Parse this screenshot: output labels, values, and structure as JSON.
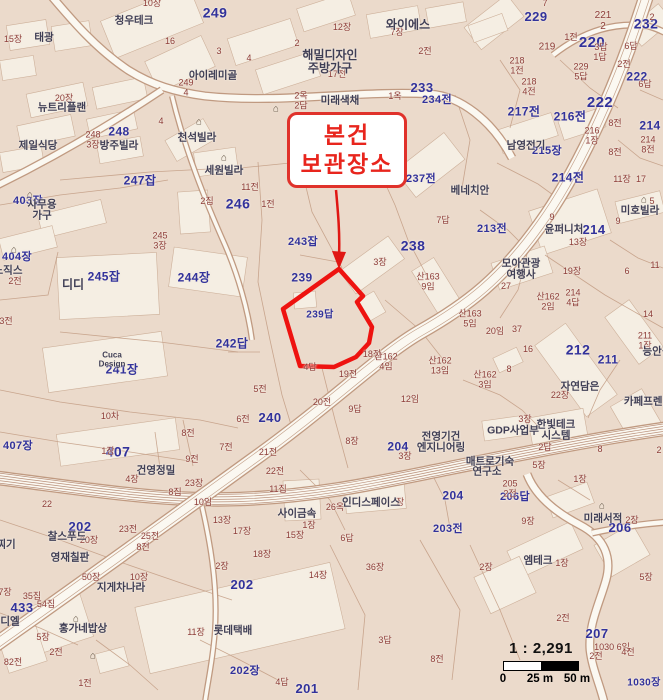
{
  "callout": {
    "text": "본건\n보관장소"
  },
  "scalebar": {
    "ratio": "1 : 2,291",
    "tick_0": "0",
    "tick_25": "25 m",
    "tick_50": "50 m"
  },
  "colors": {
    "map_background": "#ebdacb",
    "lot_number_blue": "#32329b",
    "sub_lot_red": "#8d3c38",
    "building_name": "#3f3e55",
    "highlight_red": "#ee1310"
  },
  "map_labels": [
    {
      "t": "249",
      "x": 215,
      "y": 13,
      "c": "b",
      "s": 14
    },
    {
      "t": "229",
      "x": 536,
      "y": 17,
      "c": "b",
      "s": 13
    },
    {
      "t": "220",
      "x": 592,
      "y": 43,
      "c": "b",
      "s": 15
    },
    {
      "t": "232",
      "x": 646,
      "y": 24,
      "c": "b",
      "s": 14
    },
    {
      "t": "233",
      "x": 422,
      "y": 88,
      "c": "b",
      "s": 13
    },
    {
      "t": "234전",
      "x": 437,
      "y": 101,
      "c": "b",
      "s": 11
    },
    {
      "t": "238",
      "x": 413,
      "y": 246,
      "c": "b",
      "s": 14
    },
    {
      "t": "237전",
      "x": 421,
      "y": 180,
      "c": "b",
      "s": 11
    },
    {
      "t": "213전",
      "x": 492,
      "y": 230,
      "c": "b",
      "s": 11
    },
    {
      "t": "214",
      "x": 594,
      "y": 230,
      "c": "b",
      "s": 13
    },
    {
      "t": "214전",
      "x": 568,
      "y": 178,
      "c": "b",
      "s": 12
    },
    {
      "t": "217전",
      "x": 524,
      "y": 112,
      "c": "b",
      "s": 12
    },
    {
      "t": "216전",
      "x": 570,
      "y": 117,
      "c": "b",
      "s": 12
    },
    {
      "t": "214",
      "x": 650,
      "y": 126,
      "c": "b",
      "s": 12
    },
    {
      "t": "222",
      "x": 600,
      "y": 103,
      "c": "b",
      "s": 15
    },
    {
      "t": "222",
      "x": 637,
      "y": 77,
      "c": "b",
      "s": 12
    },
    {
      "t": "212",
      "x": 578,
      "y": 350,
      "c": "b",
      "s": 14
    },
    {
      "t": "211",
      "x": 608,
      "y": 360,
      "c": "b",
      "s": 12
    },
    {
      "t": "239",
      "x": 302,
      "y": 278,
      "c": "b",
      "s": 12
    },
    {
      "t": "239답",
      "x": 320,
      "y": 316,
      "c": "b",
      "s": 10
    },
    {
      "t": "243잡",
      "x": 303,
      "y": 243,
      "c": "b",
      "s": 11
    },
    {
      "t": "247잡",
      "x": 140,
      "y": 181,
      "c": "b",
      "s": 12
    },
    {
      "t": "246",
      "x": 238,
      "y": 204,
      "c": "b",
      "s": 14
    },
    {
      "t": "248",
      "x": 119,
      "y": 132,
      "c": "b",
      "s": 12
    },
    {
      "t": "245잡",
      "x": 104,
      "y": 277,
      "c": "b",
      "s": 12
    },
    {
      "t": "244장",
      "x": 194,
      "y": 278,
      "c": "b",
      "s": 12
    },
    {
      "t": "242답",
      "x": 232,
      "y": 344,
      "c": "b",
      "s": 12
    },
    {
      "t": "241장",
      "x": 122,
      "y": 370,
      "c": "b",
      "s": 12
    },
    {
      "t": "240",
      "x": 270,
      "y": 418,
      "c": "b",
      "s": 13
    },
    {
      "t": "407",
      "x": 118,
      "y": 452,
      "c": "b",
      "s": 14
    },
    {
      "t": "407장",
      "x": 18,
      "y": 447,
      "c": "b",
      "s": 11
    },
    {
      "t": "433",
      "x": 22,
      "y": 608,
      "c": "b",
      "s": 13
    },
    {
      "t": "404장",
      "x": 17,
      "y": 258,
      "c": "b",
      "s": 11
    },
    {
      "t": "403장",
      "x": 28,
      "y": 202,
      "c": "b",
      "s": 11
    },
    {
      "t": "202",
      "x": 80,
      "y": 527,
      "c": "b",
      "s": 13
    },
    {
      "t": "202",
      "x": 242,
      "y": 585,
      "c": "b",
      "s": 13
    },
    {
      "t": "202장",
      "x": 245,
      "y": 672,
      "c": "b",
      "s": 11
    },
    {
      "t": "201",
      "x": 307,
      "y": 689,
      "c": "b",
      "s": 13
    },
    {
      "t": "204",
      "x": 453,
      "y": 496,
      "c": "b",
      "s": 12
    },
    {
      "t": "203전",
      "x": 448,
      "y": 530,
      "c": "b",
      "s": 11
    },
    {
      "t": "204",
      "x": 398,
      "y": 447,
      "c": "b",
      "s": 12
    },
    {
      "t": "206답",
      "x": 515,
      "y": 498,
      "c": "b",
      "s": 11
    },
    {
      "t": "206",
      "x": 620,
      "y": 528,
      "c": "b",
      "s": 13
    },
    {
      "t": "207",
      "x": 597,
      "y": 634,
      "c": "b",
      "s": 13
    },
    {
      "t": "1030장",
      "x": 644,
      "y": 684,
      "c": "b",
      "s": 10
    },
    {
      "t": "215장",
      "x": 547,
      "y": 152,
      "c": "b",
      "s": 11
    },
    {
      "t": "15장",
      "x": 13,
      "y": 40,
      "c": "r"
    },
    {
      "t": "10장",
      "x": 152,
      "y": 4,
      "c": "r"
    },
    {
      "t": "16",
      "x": 170,
      "y": 42,
      "c": "r"
    },
    {
      "t": "3",
      "x": 219,
      "y": 52,
      "c": "r"
    },
    {
      "t": "4",
      "x": 249,
      "y": 59,
      "c": "r"
    },
    {
      "t": "2",
      "x": 297,
      "y": 44,
      "c": "r"
    },
    {
      "t": "12장",
      "x": 342,
      "y": 28,
      "c": "r"
    },
    {
      "t": "7장",
      "x": 397,
      "y": 33,
      "c": "r"
    },
    {
      "t": "2전",
      "x": 425,
      "y": 52,
      "c": "r"
    },
    {
      "t": "17전",
      "x": 337,
      "y": 75,
      "c": "r"
    },
    {
      "t": "1옥",
      "x": 395,
      "y": 97,
      "c": "r"
    },
    {
      "t": "2옥\n2담",
      "x": 301,
      "y": 101,
      "c": "r"
    },
    {
      "t": "249\n4",
      "x": 186,
      "y": 88,
      "c": "r"
    },
    {
      "t": "20장",
      "x": 64,
      "y": 99,
      "c": "r"
    },
    {
      "t": "248\n3장",
      "x": 93,
      "y": 140,
      "c": "r"
    },
    {
      "t": "4",
      "x": 161,
      "y": 122,
      "c": "r"
    },
    {
      "t": "2집",
      "x": 207,
      "y": 202,
      "c": "r"
    },
    {
      "t": "11전",
      "x": 250,
      "y": 188,
      "c": "r"
    },
    {
      "t": "1전",
      "x": 268,
      "y": 205,
      "c": "r"
    },
    {
      "t": "3장",
      "x": 380,
      "y": 263,
      "c": "r"
    },
    {
      "t": "7답",
      "x": 443,
      "y": 221,
      "c": "r"
    },
    {
      "t": "산163\n9임",
      "x": 428,
      "y": 282,
      "c": "r"
    },
    {
      "t": "산163\n5임",
      "x": 470,
      "y": 319,
      "c": "r"
    },
    {
      "t": "20임",
      "x": 495,
      "y": 332,
      "c": "r"
    },
    {
      "t": "37",
      "x": 517,
      "y": 330,
      "c": "r"
    },
    {
      "t": "16",
      "x": 528,
      "y": 350,
      "c": "r"
    },
    {
      "t": "8",
      "x": 509,
      "y": 370,
      "c": "r"
    },
    {
      "t": "산162\n3임",
      "x": 485,
      "y": 380,
      "c": "r"
    },
    {
      "t": "1전",
      "x": 571,
      "y": 38,
      "c": "r"
    },
    {
      "t": "3답",
      "x": 601,
      "y": 48,
      "c": "r"
    },
    {
      "t": "6답",
      "x": 631,
      "y": 47,
      "c": "r"
    },
    {
      "t": "1답",
      "x": 600,
      "y": 58,
      "c": "r"
    },
    {
      "t": "2전",
      "x": 624,
      "y": 65,
      "c": "r"
    },
    {
      "t": "219",
      "x": 547,
      "y": 48,
      "c": "r",
      "s": 10
    },
    {
      "t": "218\n1전",
      "x": 517,
      "y": 66,
      "c": "r"
    },
    {
      "t": "218\n4전",
      "x": 529,
      "y": 87,
      "c": "r"
    },
    {
      "t": "229\n5답",
      "x": 581,
      "y": 72,
      "c": "r"
    },
    {
      "t": "7",
      "x": 545,
      "y": 4,
      "c": "r"
    },
    {
      "t": "2",
      "x": 652,
      "y": 18,
      "c": "r"
    },
    {
      "t": "221\n2",
      "x": 603,
      "y": 22,
      "c": "r",
      "s": 10
    },
    {
      "t": "6답",
      "x": 645,
      "y": 85,
      "c": "r"
    },
    {
      "t": "8전",
      "x": 615,
      "y": 124,
      "c": "r"
    },
    {
      "t": "216\n1장",
      "x": 592,
      "y": 136,
      "c": "r"
    },
    {
      "t": "214\n8전",
      "x": 648,
      "y": 145,
      "c": "r"
    },
    {
      "t": "8전",
      "x": 615,
      "y": 153,
      "c": "r"
    },
    {
      "t": "11장",
      "x": 622,
      "y": 180,
      "c": "r"
    },
    {
      "t": "17",
      "x": 641,
      "y": 180,
      "c": "r"
    },
    {
      "t": "5",
      "x": 652,
      "y": 202,
      "c": "r"
    },
    {
      "t": "9",
      "x": 552,
      "y": 218,
      "c": "r"
    },
    {
      "t": "9",
      "x": 618,
      "y": 222,
      "c": "r"
    },
    {
      "t": "13장",
      "x": 578,
      "y": 243,
      "c": "r"
    },
    {
      "t": "19장",
      "x": 572,
      "y": 272,
      "c": "r"
    },
    {
      "t": "6",
      "x": 627,
      "y": 272,
      "c": "r"
    },
    {
      "t": "11",
      "x": 655,
      "y": 266,
      "c": "r"
    },
    {
      "t": "27",
      "x": 506,
      "y": 287,
      "c": "r"
    },
    {
      "t": "산162\n2임",
      "x": 548,
      "y": 302,
      "c": "r"
    },
    {
      "t": "214\n4답",
      "x": 573,
      "y": 298,
      "c": "r"
    },
    {
      "t": "14",
      "x": 648,
      "y": 315,
      "c": "r"
    },
    {
      "t": "211\n1장",
      "x": 645,
      "y": 341,
      "c": "r"
    },
    {
      "t": "22장",
      "x": 560,
      "y": 396,
      "c": "r"
    },
    {
      "t": "3장",
      "x": 525,
      "y": 420,
      "c": "r"
    },
    {
      "t": "8",
      "x": 600,
      "y": 450,
      "c": "r"
    },
    {
      "t": "2",
      "x": 659,
      "y": 451,
      "c": "r"
    },
    {
      "t": "2답",
      "x": 545,
      "y": 448,
      "c": "r"
    },
    {
      "t": "5장",
      "x": 539,
      "y": 466,
      "c": "r"
    },
    {
      "t": "1장",
      "x": 580,
      "y": 480,
      "c": "r"
    },
    {
      "t": "205\n2전",
      "x": 510,
      "y": 489,
      "c": "r"
    },
    {
      "t": "9장",
      "x": 528,
      "y": 522,
      "c": "r"
    },
    {
      "t": "2장",
      "x": 632,
      "y": 521,
      "c": "r"
    },
    {
      "t": "1장",
      "x": 562,
      "y": 564,
      "c": "r"
    },
    {
      "t": "2장",
      "x": 486,
      "y": 568,
      "c": "r"
    },
    {
      "t": "5장",
      "x": 646,
      "y": 578,
      "c": "r"
    },
    {
      "t": "2전",
      "x": 563,
      "y": 619,
      "c": "r"
    },
    {
      "t": "1030 6임",
      "x": 612,
      "y": 648,
      "c": "r"
    },
    {
      "t": "2전",
      "x": 596,
      "y": 657,
      "c": "r"
    },
    {
      "t": "4전",
      "x": 628,
      "y": 653,
      "c": "r"
    },
    {
      "t": "4장",
      "x": 132,
      "y": 480,
      "c": "r"
    },
    {
      "t": "8집",
      "x": 175,
      "y": 493,
      "c": "r"
    },
    {
      "t": "23장",
      "x": 194,
      "y": 484,
      "c": "r"
    },
    {
      "t": "10임",
      "x": 203,
      "y": 503,
      "c": "r"
    },
    {
      "t": "13장",
      "x": 222,
      "y": 521,
      "c": "r"
    },
    {
      "t": "22",
      "x": 47,
      "y": 505,
      "c": "r"
    },
    {
      "t": "20장",
      "x": 89,
      "y": 541,
      "c": "r"
    },
    {
      "t": "23전",
      "x": 128,
      "y": 530,
      "c": "r"
    },
    {
      "t": "25전",
      "x": 150,
      "y": 537,
      "c": "r"
    },
    {
      "t": "8전",
      "x": 143,
      "y": 548,
      "c": "r"
    },
    {
      "t": "10장",
      "x": 139,
      "y": 578,
      "c": "r"
    },
    {
      "t": "50장",
      "x": 91,
      "y": 578,
      "c": "r"
    },
    {
      "t": "35집",
      "x": 32,
      "y": 597,
      "c": "r"
    },
    {
      "t": "54집",
      "x": 46,
      "y": 605,
      "c": "r"
    },
    {
      "t": "7장",
      "x": 5,
      "y": 593,
      "c": "r"
    },
    {
      "t": "2전",
      "x": 56,
      "y": 653,
      "c": "r"
    },
    {
      "t": "5장",
      "x": 43,
      "y": 638,
      "c": "r"
    },
    {
      "t": "82전",
      "x": 13,
      "y": 663,
      "c": "r"
    },
    {
      "t": "1전",
      "x": 85,
      "y": 684,
      "c": "r"
    },
    {
      "t": "11장",
      "x": 196,
      "y": 633,
      "c": "r"
    },
    {
      "t": "2장",
      "x": 222,
      "y": 567,
      "c": "r"
    },
    {
      "t": "22전",
      "x": 275,
      "y": 472,
      "c": "r"
    },
    {
      "t": "11집",
      "x": 278,
      "y": 490,
      "c": "r"
    },
    {
      "t": "26옥",
      "x": 335,
      "y": 508,
      "c": "r"
    },
    {
      "t": "장",
      "x": 400,
      "y": 503,
      "c": "r"
    },
    {
      "t": "17장",
      "x": 242,
      "y": 532,
      "c": "r"
    },
    {
      "t": "15장",
      "x": 295,
      "y": 536,
      "c": "r"
    },
    {
      "t": "1장",
      "x": 309,
      "y": 526,
      "c": "r"
    },
    {
      "t": "6답",
      "x": 347,
      "y": 539,
      "c": "r"
    },
    {
      "t": "18장",
      "x": 262,
      "y": 555,
      "c": "r"
    },
    {
      "t": "36장",
      "x": 375,
      "y": 568,
      "c": "r"
    },
    {
      "t": "14장",
      "x": 318,
      "y": 576,
      "c": "r"
    },
    {
      "t": "3답",
      "x": 385,
      "y": 641,
      "c": "r"
    },
    {
      "t": "8전",
      "x": 437,
      "y": 660,
      "c": "r"
    },
    {
      "t": "4답",
      "x": 282,
      "y": 683,
      "c": "r"
    },
    {
      "t": "7전",
      "x": 226,
      "y": 448,
      "c": "r"
    },
    {
      "t": "9전",
      "x": 192,
      "y": 460,
      "c": "r"
    },
    {
      "t": "8전",
      "x": 188,
      "y": 434,
      "c": "r"
    },
    {
      "t": "21전",
      "x": 268,
      "y": 453,
      "c": "r"
    },
    {
      "t": "20전",
      "x": 322,
      "y": 403,
      "c": "r"
    },
    {
      "t": "9답",
      "x": 355,
      "y": 410,
      "c": "r"
    },
    {
      "t": "12임",
      "x": 410,
      "y": 400,
      "c": "r"
    },
    {
      "t": "6전",
      "x": 243,
      "y": 420,
      "c": "r"
    },
    {
      "t": "5전",
      "x": 260,
      "y": 390,
      "c": "r"
    },
    {
      "t": "8장",
      "x": 352,
      "y": 442,
      "c": "r"
    },
    {
      "t": "3장",
      "x": 405,
      "y": 457,
      "c": "r"
    },
    {
      "t": "19전",
      "x": 348,
      "y": 375,
      "c": "r"
    },
    {
      "t": "18전",
      "x": 372,
      "y": 355,
      "c": "r"
    },
    {
      "t": "산162\n4임",
      "x": 386,
      "y": 362,
      "c": "r"
    },
    {
      "t": "산162\n13임",
      "x": 440,
      "y": 366,
      "c": "r"
    },
    {
      "t": "4답",
      "x": 310,
      "y": 368,
      "c": "r"
    },
    {
      "t": "10차",
      "x": 110,
      "y": 417,
      "c": "r"
    },
    {
      "t": "1장",
      "x": 108,
      "y": 452,
      "c": "r"
    },
    {
      "t": "245\n3장",
      "x": 160,
      "y": 241,
      "c": "r"
    },
    {
      "t": "2전",
      "x": 15,
      "y": 282,
      "c": "r"
    },
    {
      "t": "3전",
      "x": 6,
      "y": 322,
      "c": "r"
    },
    {
      "t": "태광",
      "x": 44,
      "y": 38,
      "c": "d"
    },
    {
      "t": "청우테크",
      "x": 134,
      "y": 21,
      "c": "d"
    },
    {
      "t": "뉴트리플랜",
      "x": 62,
      "y": 108,
      "c": "d"
    },
    {
      "t": "제일식당",
      "x": 38,
      "y": 146,
      "c": "d"
    },
    {
      "t": "방주빌라",
      "x": 119,
      "y": 146,
      "c": "d"
    },
    {
      "t": "천석빌라",
      "x": 197,
      "y": 138,
      "c": "d"
    },
    {
      "t": "아이레미골",
      "x": 213,
      "y": 76,
      "c": "d"
    },
    {
      "t": "해밀디자인\n주방가구",
      "x": 330,
      "y": 62,
      "c": "d",
      "s": 12
    },
    {
      "t": "와이에스",
      "x": 408,
      "y": 25,
      "c": "d",
      "s": 12
    },
    {
      "t": "미래색채",
      "x": 340,
      "y": 101,
      "c": "d"
    },
    {
      "t": "세원빌라",
      "x": 224,
      "y": 171,
      "c": "d"
    },
    {
      "t": "남영전기",
      "x": 526,
      "y": 146,
      "c": "d"
    },
    {
      "t": "미호빌라",
      "x": 640,
      "y": 211,
      "c": "d"
    },
    {
      "t": "윤퍼니처",
      "x": 564,
      "y": 230,
      "c": "d"
    },
    {
      "t": "모아관광\n여행사",
      "x": 521,
      "y": 270,
      "c": "d"
    },
    {
      "t": "베네치안",
      "x": 470,
      "y": 191,
      "c": "d"
    },
    {
      "t": "디디",
      "x": 73,
      "y": 285,
      "c": "d",
      "s": 12
    },
    {
      "t": "사무용\n가구",
      "x": 42,
      "y": 211,
      "c": "d"
    },
    {
      "t": "노직스",
      "x": 8,
      "y": 271,
      "c": "d"
    },
    {
      "t": "찌기",
      "x": 6,
      "y": 545,
      "c": "d"
    },
    {
      "t": "찰스푸드",
      "x": 67,
      "y": 537,
      "c": "d"
    },
    {
      "t": "영재칠판",
      "x": 70,
      "y": 558,
      "c": "d"
    },
    {
      "t": "지게차나라",
      "x": 121,
      "y": 588,
      "c": "d"
    },
    {
      "t": "디엘",
      "x": 10,
      "y": 622,
      "c": "d"
    },
    {
      "t": "홍가네밥상",
      "x": 83,
      "y": 629,
      "c": "d"
    },
    {
      "t": "롯데택배",
      "x": 233,
      "y": 631,
      "c": "d"
    },
    {
      "t": "사이금속",
      "x": 297,
      "y": 514,
      "c": "d"
    },
    {
      "t": "인디스페이스",
      "x": 371,
      "y": 503,
      "c": "d"
    },
    {
      "t": "엠테크",
      "x": 538,
      "y": 561,
      "c": "d"
    },
    {
      "t": "미래서적",
      "x": 603,
      "y": 519,
      "c": "d"
    },
    {
      "t": "연구소",
      "x": 487,
      "y": 472,
      "c": "d"
    },
    {
      "t": "건영정밀",
      "x": 156,
      "y": 471,
      "c": "d"
    },
    {
      "t": "한빛테크\n시스템",
      "x": 556,
      "y": 431,
      "c": "d"
    },
    {
      "t": "GDP사업부",
      "x": 513,
      "y": 431,
      "c": "d"
    },
    {
      "t": "전영기건\n엔지니어링",
      "x": 441,
      "y": 443,
      "c": "d"
    },
    {
      "t": "매트로기숙",
      "x": 490,
      "y": 462,
      "c": "d"
    },
    {
      "t": "자연담은",
      "x": 580,
      "y": 387,
      "c": "d"
    },
    {
      "t": "카페프렌치",
      "x": 648,
      "y": 402,
      "c": "d"
    },
    {
      "t": "능안길",
      "x": 657,
      "y": 352,
      "c": "d"
    },
    {
      "t": "Cuca\nDesign",
      "x": 112,
      "y": 360,
      "c": "d",
      "s": 8
    },
    {
      "t": "⌂",
      "x": 224,
      "y": 159,
      "c": "p"
    },
    {
      "t": "⌂",
      "x": 199,
      "y": 123,
      "c": "p"
    },
    {
      "t": "⌂",
      "x": 30,
      "y": 196,
      "c": "p"
    },
    {
      "t": "⌂",
      "x": 14,
      "y": 251,
      "c": "p"
    },
    {
      "t": "⌂",
      "x": 76,
      "y": 620,
      "c": "p"
    },
    {
      "t": "⌂",
      "x": 644,
      "y": 201,
      "c": "p"
    },
    {
      "t": "⌂",
      "x": 602,
      "y": 507,
      "c": "p"
    },
    {
      "t": "⌂",
      "x": 276,
      "y": 110,
      "c": "p"
    },
    {
      "t": "⌂",
      "x": 93,
      "y": 657,
      "c": "p"
    }
  ]
}
